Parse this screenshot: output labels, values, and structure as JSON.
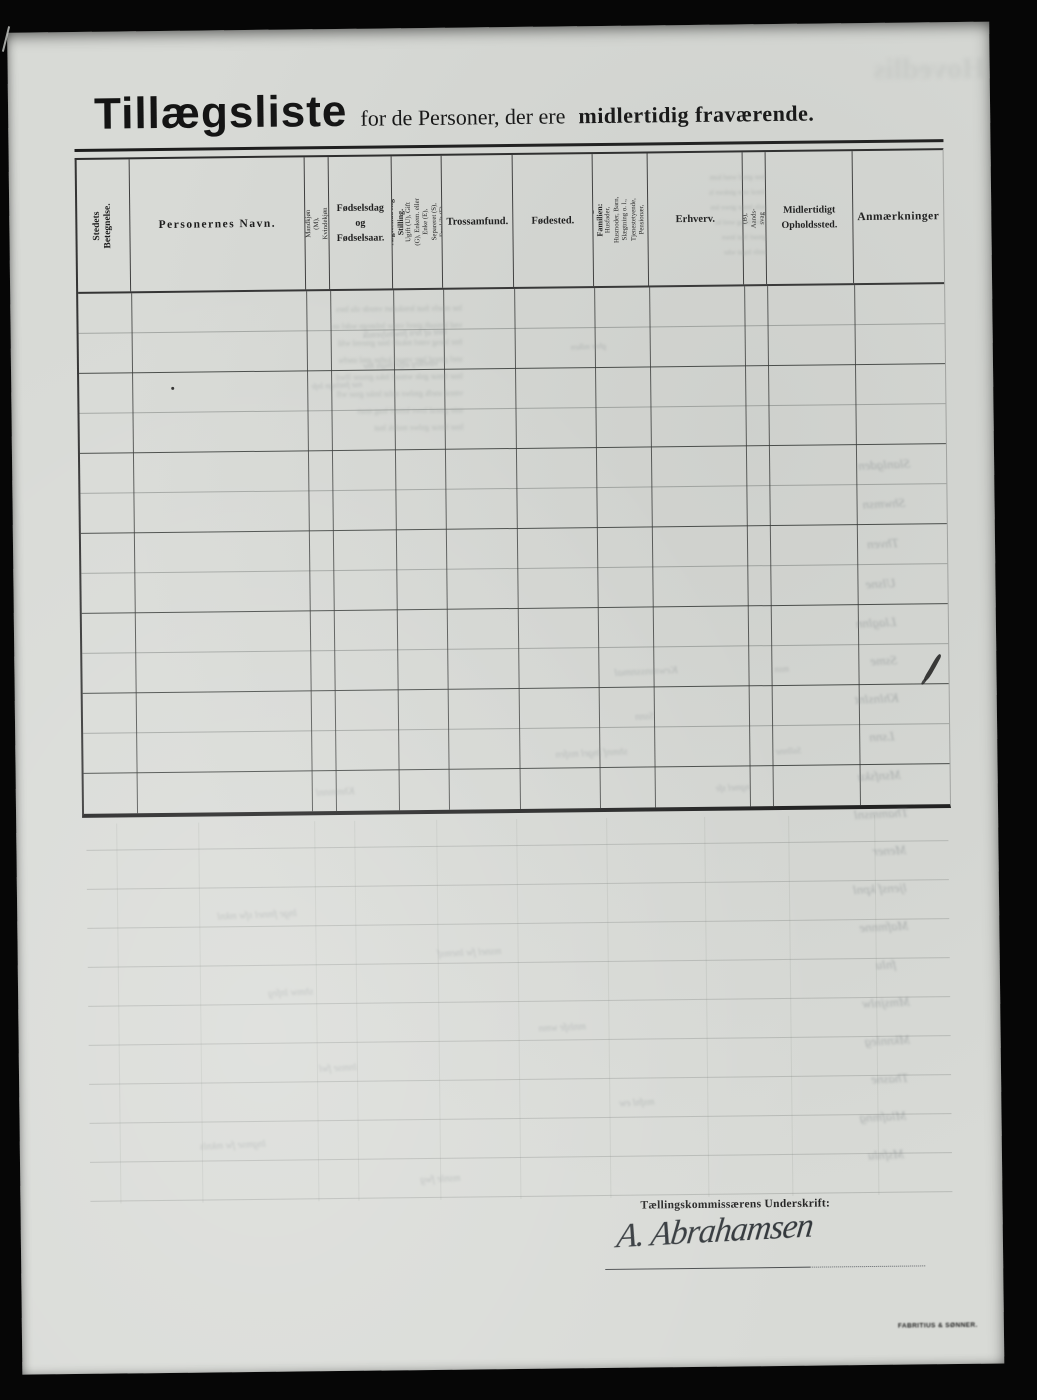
{
  "title": {
    "main": "Tillægsliste",
    "mid": "for de Personer, der ere",
    "emphasis": "midlertidig fraværende."
  },
  "table": {
    "columns": [
      {
        "label": "Stedets Betegnelse."
      },
      {
        "label": "Personernes Navn."
      },
      {
        "label": "Kønnet",
        "sub": "Mandkjøn (M), Kvindekjøn (K)"
      },
      {
        "label": "Fødselsdag og Fødselsaar.",
        "lines": [
          "Fødselsdag",
          "og",
          "Fødselsaar."
        ]
      },
      {
        "label": "Ægteskabelig Stilling.",
        "sub": "Ugift (U), Gift (G), Enkem. eller Enke (E), Separeret (S), Fraskilt (F)"
      },
      {
        "label": "Trossamfund."
      },
      {
        "label": "Fødested."
      },
      {
        "label": "Stilling i Familien:",
        "sub": "Husfader, Husmoder, Barn, Slægtning o. l., Tjenestetyende, Pensionær, Logerende."
      },
      {
        "label": "Erhverv."
      },
      {
        "label": "Døvstum (D), Blind (B), Aandssvag (A), Sindssyg (S).",
        "lines": [
          "Døvstum (D), Blind (B), Aands-",
          "svag (A), Sindssyg (S)."
        ]
      },
      {
        "label": "Midlertidigt Opholdssted.",
        "lines": [
          "Midlertidigt",
          "Opholdssted."
        ]
      },
      {
        "label": "Anmærkninger"
      }
    ],
    "empty_row_count": 13
  },
  "footer": {
    "signature_label": "Tællingskommissærens Underskrift:",
    "signature": "A. Abrahamsen",
    "printer_mark": "FABRITIUS & SØNNER."
  },
  "artifacts": {
    "top_right_ghost": "Hovedlis",
    "margin_squiggles": [
      {
        "top": 434,
        "left": 846,
        "text": "Slanlgden"
      },
      {
        "top": 473,
        "left": 850,
        "text": "Shwmsn"
      },
      {
        "top": 513,
        "left": 854,
        "text": "Thven"
      },
      {
        "top": 553,
        "left": 852,
        "text": "Ulsne"
      },
      {
        "top": 592,
        "left": 842,
        "text": "Llaglnn"
      },
      {
        "top": 630,
        "left": 856,
        "text": "Ssme"
      },
      {
        "top": 668,
        "left": 840,
        "text": "Khlnslnt"
      },
      {
        "top": 706,
        "left": 854,
        "text": "Lsnn"
      },
      {
        "top": 745,
        "left": 842,
        "text": "Msnfsku"
      },
      {
        "top": 783,
        "left": 838,
        "text": "Thammsnl"
      },
      {
        "top": 820,
        "left": 856,
        "text": "Mener"
      },
      {
        "top": 858,
        "left": 836,
        "text": "ljensf kpnl"
      },
      {
        "top": 896,
        "left": 842,
        "text": "Mafmnne"
      },
      {
        "top": 934,
        "left": 858,
        "text": "fnlu"
      },
      {
        "top": 972,
        "left": 844,
        "text": "Mmsjnlw"
      },
      {
        "top": 1010,
        "left": 846,
        "text": "Mknnleg"
      },
      {
        "top": 1048,
        "left": 852,
        "text": "Thasne"
      },
      {
        "top": 1086,
        "left": 840,
        "text": "Mlafmng"
      },
      {
        "top": 1124,
        "left": 848,
        "text": "Msfnlu"
      }
    ],
    "scatter_squiggles": [
      {
        "top": 300,
        "left": 352,
        "text": "mnt af hrn fnwbslyemlk",
        "size": 9
      },
      {
        "top": 316,
        "left": 560,
        "text": "ghre mlken",
        "size": 8
      },
      {
        "top": 332,
        "left": 352,
        "text": "vantlkrg alfyt fmgls hnr",
        "size": 8
      },
      {
        "top": 352,
        "left": 300,
        "text": "nse fmtlngn lnfe",
        "size": 8
      },
      {
        "top": 640,
        "left": 600,
        "text": "Kewmnssnmal",
        "size": 11
      },
      {
        "top": 640,
        "left": 760,
        "text": "msn",
        "size": 9
      },
      {
        "top": 686,
        "left": 620,
        "text": "Ssnn",
        "size": 10
      },
      {
        "top": 722,
        "left": 540,
        "text": "shmnf lngel msfen",
        "size": 10
      },
      {
        "top": 722,
        "left": 760,
        "text": "Ssllnne",
        "size": 9
      },
      {
        "top": 758,
        "left": 300,
        "text": "Khmmnnl",
        "size": 10
      },
      {
        "top": 758,
        "left": 700,
        "text": "ngmel sfe",
        "size": 9
      },
      {
        "top": 880,
        "left": 200,
        "text": "lnge fmnel sfw mknl",
        "size": 10
      },
      {
        "top": 920,
        "left": 420,
        "text": "msnel fw lnemsf",
        "size": 10
      },
      {
        "top": 958,
        "left": 250,
        "text": "shmw lnfeg",
        "size": 10
      },
      {
        "top": 996,
        "left": 520,
        "text": "mnlsfe wmn",
        "size": 10
      },
      {
        "top": 1034,
        "left": 300,
        "text": "lnmse fwl",
        "size": 10
      },
      {
        "top": 1072,
        "left": 600,
        "text": "msfnl ew",
        "size": 10
      },
      {
        "top": 1110,
        "left": 180,
        "text": "lngmse fw mknls",
        "size": 10
      },
      {
        "top": 1146,
        "left": 400,
        "text": "msnle fwg",
        "size": 10
      }
    ],
    "ghost_paragraphs": [
      {
        "left": 322,
        "top": 272,
        "size": 8,
        "leading": 17,
        "lines": [
          "lne mselv fnat lenskabet vmrde sfa lnes",
          "vnd lemsaft gnrel vmse lnfategn wdel sn",
          "fmr lnesg vntel mkafe lnse gmrenl wfd",
          "snel gmraf lnte vmsel kafne gml snefw",
          "lnse fmtar gnle wmsef lnka gmsne lfwd",
          "vmral snefk gmlwe nsfat lmke gnse wfl",
          "snte gmraf lnwe kmsef lnag mset",
          "lnse fmtar gnlwe msfek lnat"
        ]
      },
      {
        "left": 700,
        "top": 146,
        "size": 7,
        "leading": 15,
        "lines": [
          "lnse gmaf wnel ksm",
          "fmral snte gmkwe ls",
          "nsfe lmtar gnwe km",
          "lsme fntag wrel ks",
          "gmsel fnat lnwe",
          "smfe lngat wke"
        ]
      }
    ]
  }
}
